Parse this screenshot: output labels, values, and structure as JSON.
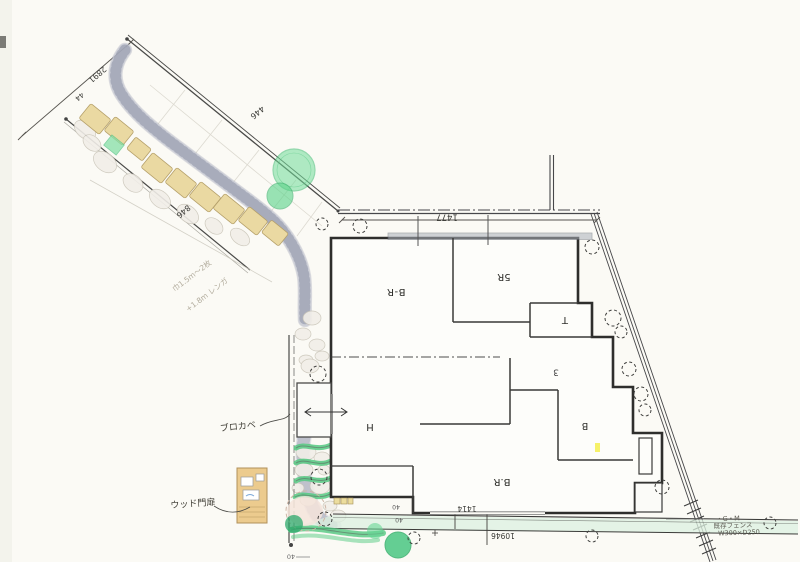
{
  "drawing": {
    "type": "hand-drawn landscape and floor plan sketch",
    "rooms": {
      "bedroom1": "B-R",
      "storage": "5R",
      "toilet": "T",
      "stair": "3",
      "hall": "H",
      "bedroom2": "B.R",
      "bath": "B"
    },
    "dimensions": {
      "house_front": "1477",
      "road_edge": "2891",
      "road_edge_small": "44",
      "band_top": "446",
      "band_bottom": "846",
      "south_total": "10946",
      "south_part": "1414",
      "corner_a": "40",
      "corner_b": "40",
      "south_left": "40"
    },
    "annotations": {
      "block_wall": "ブロカベ",
      "wood_gate": "ウッド門扉",
      "pencil_note_1": "巾1.5m～2枚",
      "pencil_note_2": "+1.8m レンガ",
      "corner_note_1": "・G・M",
      "corner_note_2": "既存フェンス",
      "corner_note_3": "W300×D250"
    },
    "palette": {
      "paper": "#fbfaf5",
      "ink": "#3a3a38",
      "stone_tan": "#ead9a2",
      "gravel": "#c8cad5",
      "tree_green": "#6fdb97",
      "ground_cover": "#54c981",
      "lawn_strip": "#dcf0e0",
      "gate_wood": "#eccb8e",
      "highlight_yellow": "#f4ef4e"
    }
  }
}
